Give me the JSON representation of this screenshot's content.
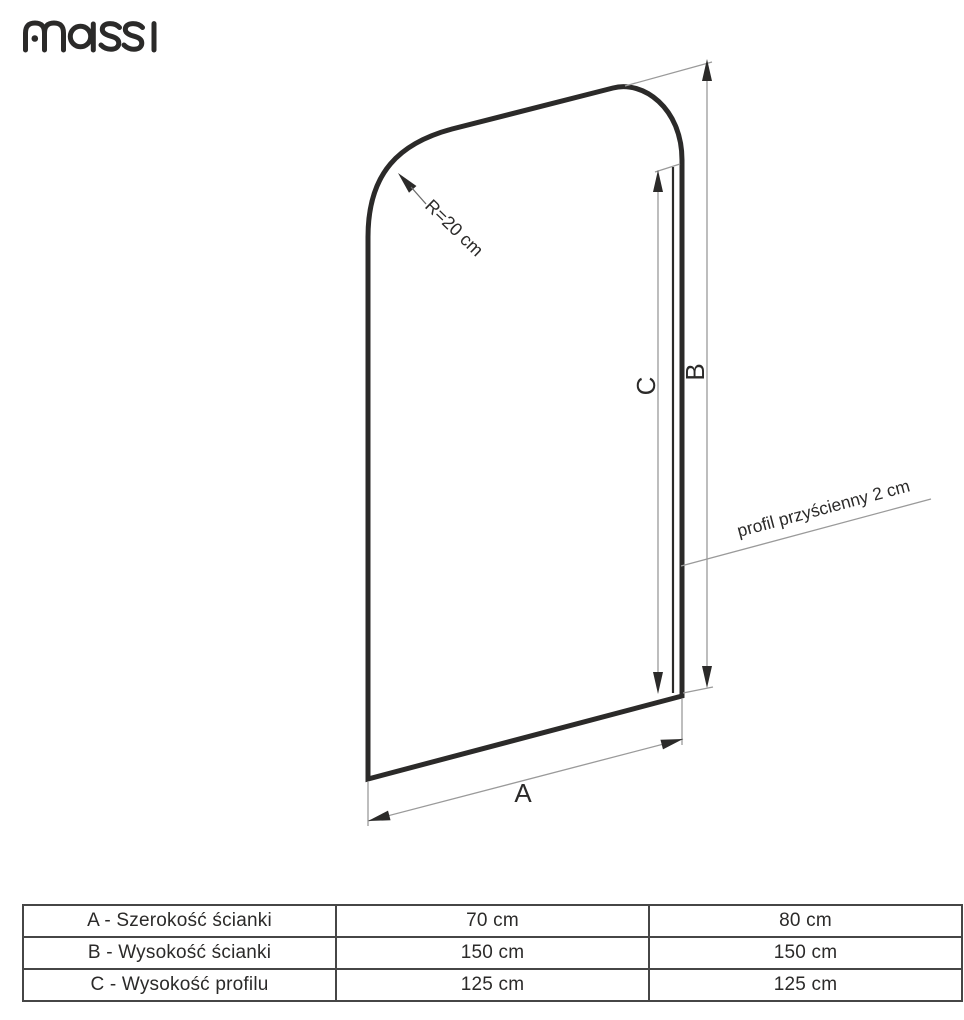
{
  "brand": {
    "name": "massi"
  },
  "drawing": {
    "radius_label": "R=20 cm",
    "profile_label": "profil przyścienny 2 cm",
    "dim_a": "A",
    "dim_b": "B",
    "dim_c": "C"
  },
  "table": {
    "rows": [
      {
        "label": "A - Szerokość ścianki",
        "col1": "70 cm",
        "col2": "80 cm"
      },
      {
        "label": "B - Wysokość ścianki",
        "col1": "150 cm",
        "col2": "150 cm"
      },
      {
        "label": "C - Wysokość profilu",
        "col1": "125 cm",
        "col2": "125 cm"
      }
    ]
  },
  "colors": {
    "ink": "#2b2a29",
    "dimension_line": "#9a9a9a",
    "table_border": "#464646",
    "background": "#ffffff"
  }
}
